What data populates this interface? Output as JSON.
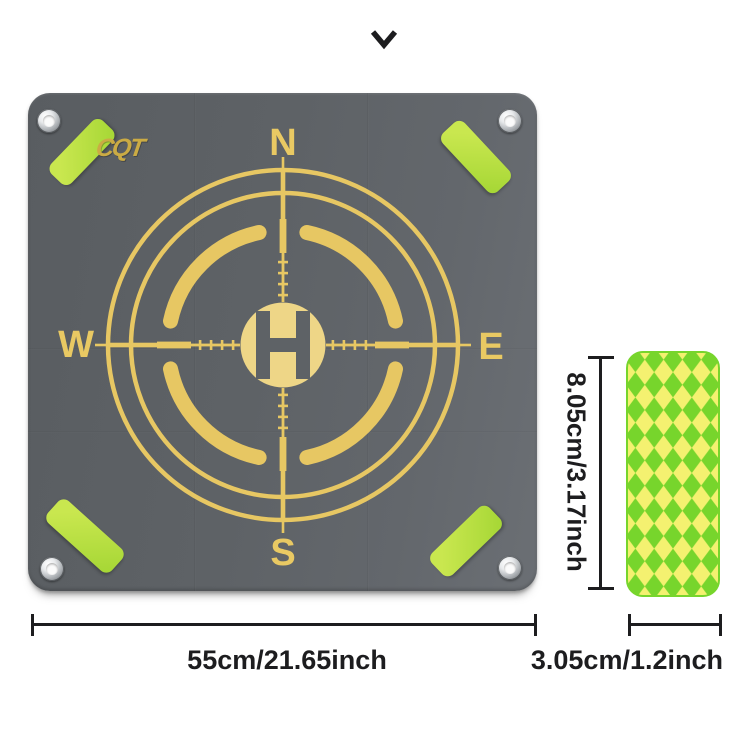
{
  "window": {
    "chevron_icon": "chevron-down"
  },
  "pad": {
    "brand": "CQT",
    "helipad_letter": "H",
    "compass": {
      "north": "N",
      "east": "E",
      "south": "S",
      "west": "W"
    },
    "corner_parts": {
      "eyelet_icon": "metal-grommet",
      "strip_icon": "reflective-green-strip"
    }
  },
  "accessory_strip": {
    "pattern_icon": "diamond-harlequin-pattern"
  },
  "dimensions": {
    "pad_width": "55cm/21.65inch",
    "strip_height": "8.05cm/3.17inch",
    "strip_width": "3.05cm/1.2inch"
  },
  "colors": {
    "pad": "#5e6266",
    "gold": "#e7c763",
    "gold-bright": "#eed687",
    "strip-green": "#c9e74f",
    "strip-green-dark": "#a4d634",
    "diamond-green": "#77d52c",
    "diamond-yellow": "#f4f170",
    "ink": "#1d1d1f"
  }
}
